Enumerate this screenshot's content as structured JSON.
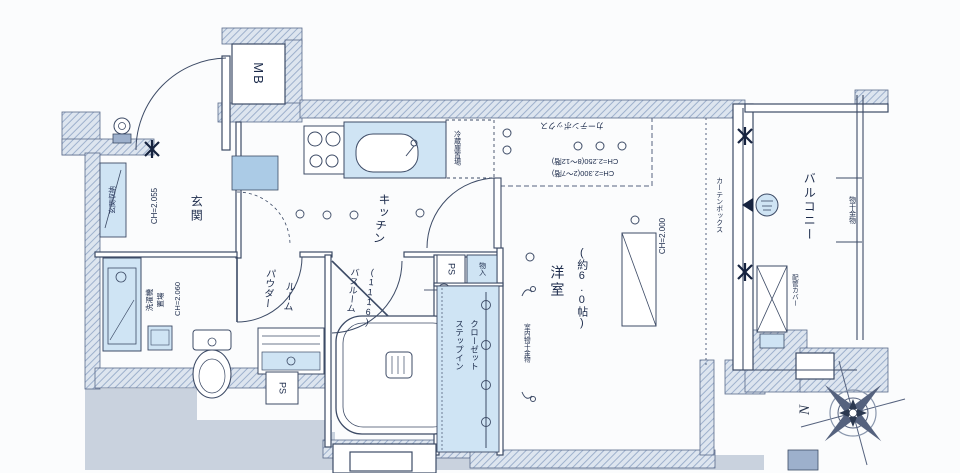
{
  "plan_title": "apartment-floor-plan",
  "labels": {
    "mb": "MB",
    "entrance": "玄関",
    "entrance_ch": "CH=2.055",
    "entrance_storage": "玄関収納",
    "kitchen": "キッチン",
    "fridge": "冷蔵庫置場",
    "ceiling_box_top": "カーテンボックス",
    "ceiling_h_upper": "CH=2.250(8〜12階)",
    "ceiling_h_lower": "CH=2.300(2〜7階)",
    "western_room": "洋室",
    "western_room_size": "(約6.0帖)",
    "window_ch": "CH=2.000",
    "curtain_box": "カーテンボックス",
    "balcony": "バルコニー",
    "pole_hardware": "物干金物",
    "pipe_cover": "配管カバー",
    "powder_room_1": "パウダー",
    "powder_room_2": "ルーム",
    "powder_ch": "CH=2.060",
    "laundry_1": "洗濯機",
    "laundry_2": "置場",
    "bathroom_1": "バスルーム",
    "bathroom_2": "(1116)",
    "ps1": "PS",
    "ps2": "PS",
    "storage_small": "物入",
    "closet_1": "ステップイン",
    "closet_2": "クローゼット",
    "indoor_hanger": "室内物干金物",
    "compass_north": "N"
  },
  "colors": {
    "wall_hatch": "#9db0cc",
    "fixture_blue": "#cfe4f4",
    "tile_blue": "#abcbe6",
    "silhouette_gray": "#c9d2de",
    "line": "#3d4b66",
    "text": "#1b2a4a"
  }
}
